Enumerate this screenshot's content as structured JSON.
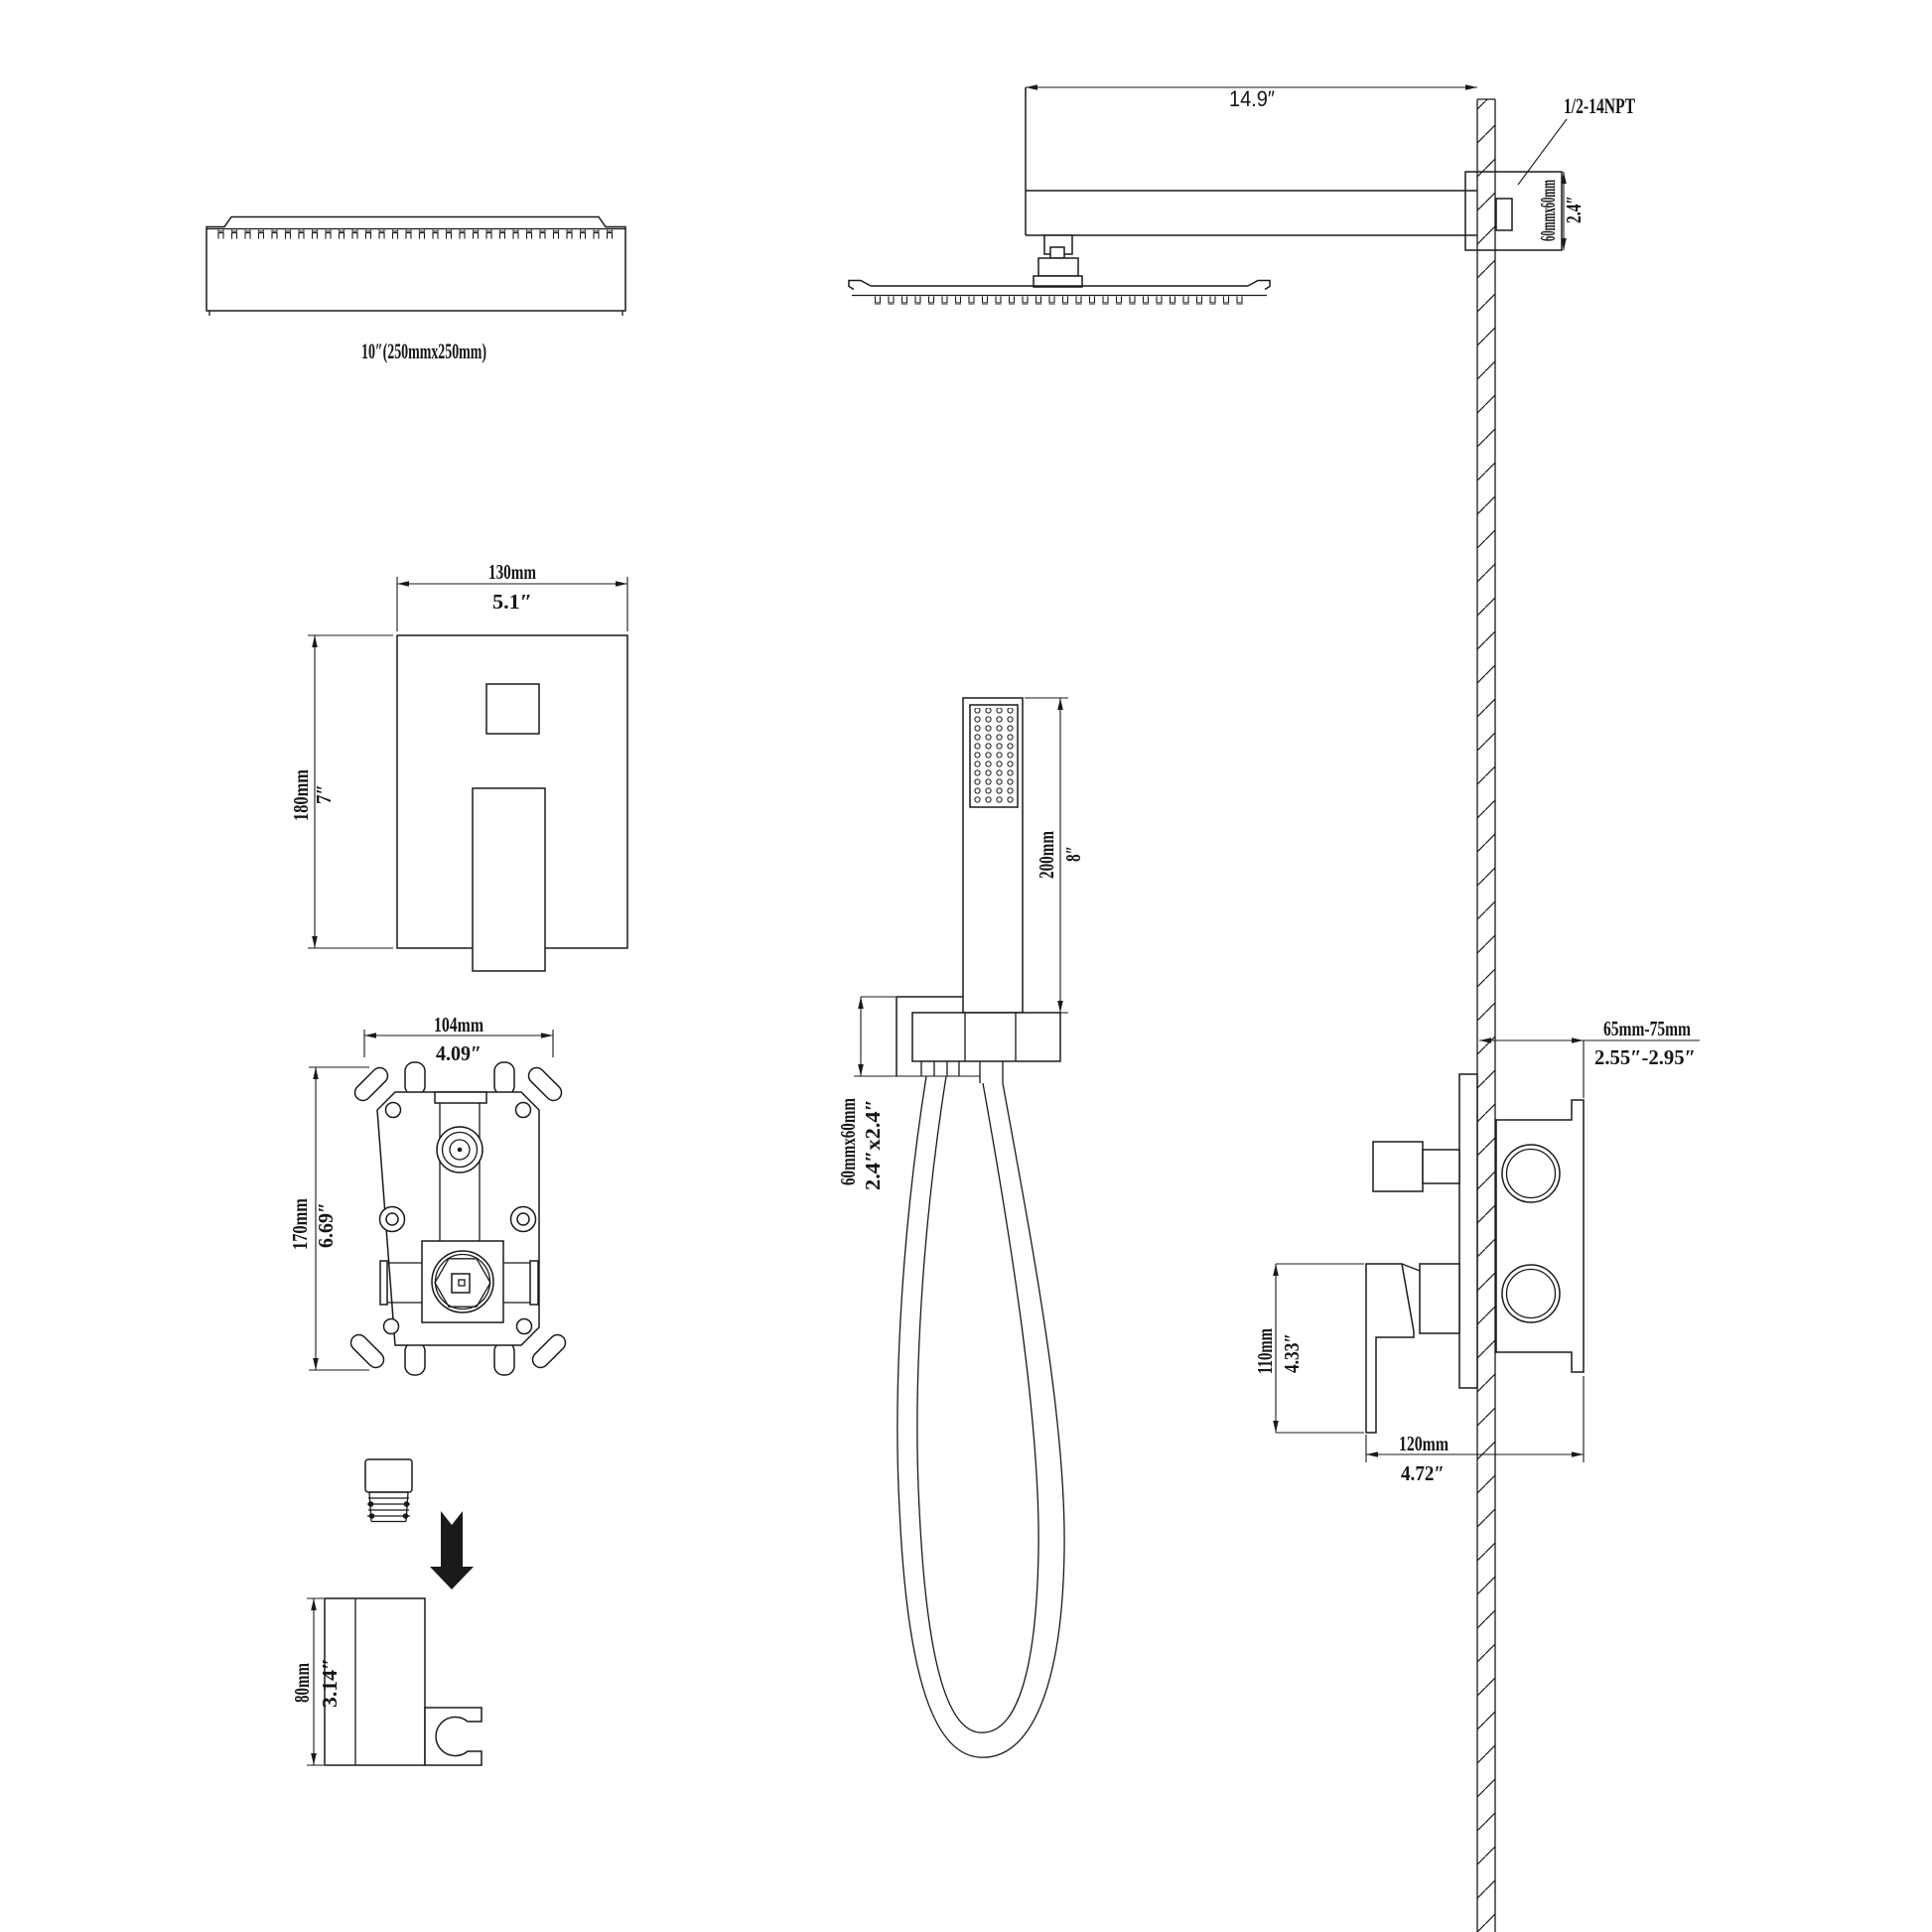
{
  "figures": {
    "head_side": {
      "size_label": "10″(250mmx250mm)"
    },
    "arm_assembly": {
      "arm_length_in": "14.9″",
      "thread_label": "1/2-14NPT",
      "flange_mm": "60mmx60mm",
      "flange_in": "2.4″"
    },
    "trim_plate": {
      "width_mm": "130mm",
      "width_in": "5.1″",
      "height_mm": "180mm",
      "height_in": "7″"
    },
    "rough_valve": {
      "width_mm": "104mm",
      "width_in": "4.09″",
      "height_mm": "170mm",
      "height_in": "6.69″"
    },
    "hand_shower": {
      "length_mm": "200mm",
      "length_in": "8″",
      "outlet_mm": "60mmx60mm",
      "outlet_in": "2.4″x2.4″"
    },
    "bracket": {
      "height_mm": "80mm",
      "height_in": "3.14″"
    },
    "mixer": {
      "depth_mm": "65mm-75mm",
      "depth_in": "2.55″-2.95″",
      "handle_mm": "110mm",
      "handle_in": "4.33″",
      "width_mm": "120mm",
      "width_in": "4.72″"
    }
  },
  "colors": {
    "line": "#1a1a1a",
    "background": "#ffffff"
  }
}
